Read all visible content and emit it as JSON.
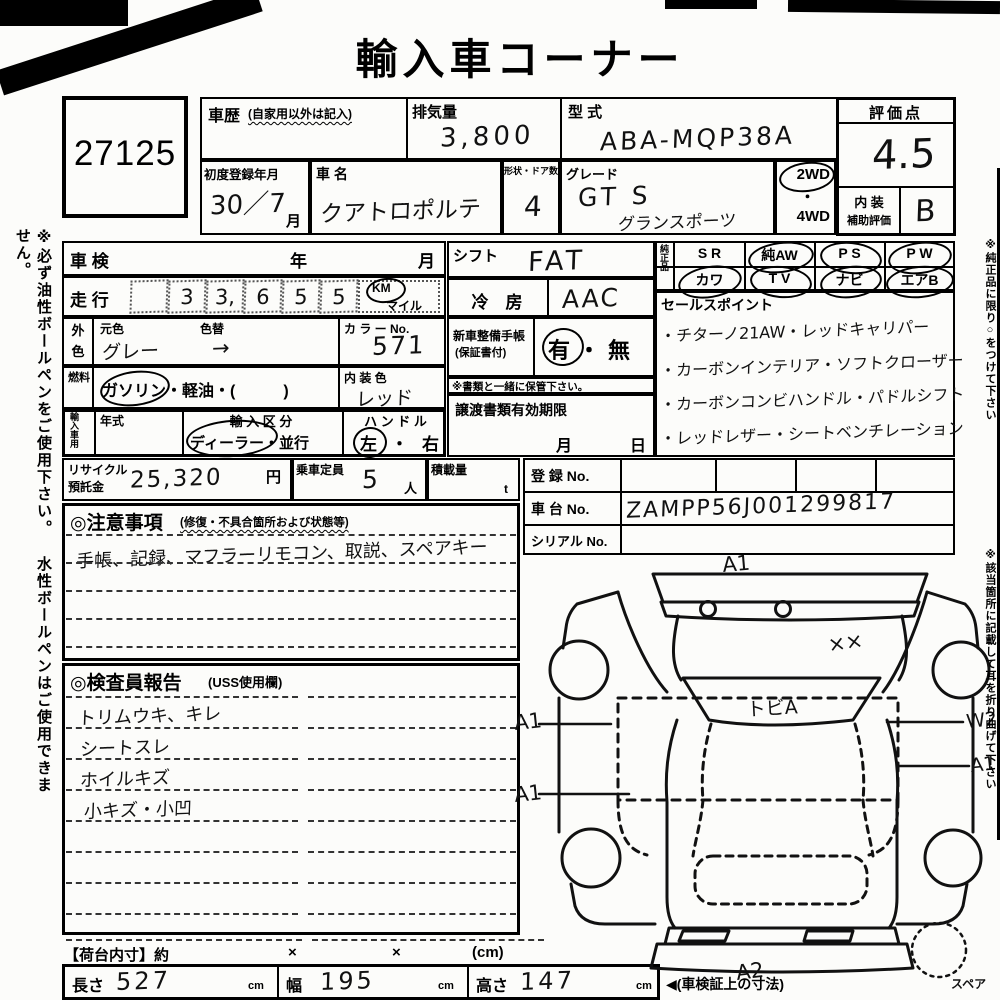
{
  "header": {
    "title": "輸入車コーナー"
  },
  "lot": {
    "number": "27125"
  },
  "margin_notes": {
    "left": "※必ず油性ボールペンをご使用下さい。 水性ボールペンはご使用できません。",
    "right1": "※純正品に限り○をつけて下さい",
    "right2": "※該当箇所に記載して耳を折り曲げて下さい"
  },
  "top": {
    "history_label": "車歴",
    "history_sub": "(自家用以外は記入)",
    "displacement_label": "排気量",
    "displacement_value": "3,800",
    "model_label": "型 式",
    "model_value": "ABA-MQP38A",
    "score_label": "評価点",
    "score_value": "4.5",
    "interior_label1": "内 装",
    "interior_label2": "補助評価",
    "interior_value": "B",
    "first_reg_label": "初度登録年月",
    "first_reg_value": "30／7",
    "first_reg_month_suffix": "月",
    "name_label": "車 名",
    "name_value": "クアトロポルテ",
    "shape_label": "形状・ドア数",
    "shape_value": "4",
    "grade_label": "グレード",
    "grade_value": "GT S",
    "grade_value2": "グランスポーツ",
    "drive_2wd": "2WD",
    "drive_dot": "・",
    "drive_4wd": "4WD",
    "drive_circled": "2WD"
  },
  "inspection_row": {
    "label": "車 検",
    "year": "年",
    "month": "月",
    "value": ""
  },
  "mileage": {
    "label": "走 行",
    "digits": [
      "",
      "3",
      "3,",
      "6",
      "5",
      "5"
    ],
    "value": "33,655",
    "unit_top": "KM",
    "unit_bottom": "マイル",
    "unit_circled": "KM"
  },
  "exterior": {
    "side_label": "外色",
    "orig_label": "元色",
    "orig_value": "グレー",
    "change_label": "色替",
    "change_value": "→",
    "colorno_label": "カ ラ ー No.",
    "colorno_value": "571"
  },
  "fuel": {
    "side_label": "燃料",
    "options": "ガソリン・軽油・(　　　)",
    "circled": "ガソリン",
    "interior_label": "内 装 色",
    "interior_value": "レッド"
  },
  "import_use": {
    "side_label": "輸入車用",
    "year_label": "年式",
    "year_value": "",
    "division_label": "輸 入 区 分",
    "division_options": "ディーラー・並行",
    "division_circled": "ディーラー",
    "handle_label": "ハ ン ド ル",
    "handle_options": "左・右",
    "handle_circled": "左"
  },
  "shift": {
    "label": "シフト",
    "value": "FAT"
  },
  "ac": {
    "label": "冷　房",
    "value": "AAC"
  },
  "service_book": {
    "label1": "新車整備手帳",
    "label2": "(保証書付)",
    "options": "有・無",
    "circled": "有",
    "note": "※書類と一緒に保管下さい。"
  },
  "transfer": {
    "label": "譲渡書類有効期限",
    "month": "月",
    "day": "日"
  },
  "genuine": {
    "side_label": "純正品",
    "cols": [
      {
        "top": "S R",
        "bottom": "カワ"
      },
      {
        "top": "純AW",
        "bottom": "T V"
      },
      {
        "top": "P S",
        "bottom": "ナビ"
      },
      {
        "top": "P W",
        "bottom": "エアB"
      }
    ],
    "circled": [
      "カワ",
      "純AW",
      "T V",
      "P S",
      "ナビ",
      "P W",
      "エアB"
    ]
  },
  "sales": {
    "label": "セールスポイント",
    "lines": [
      "・チターノ21AW・レッドキャリパー",
      "・カーボンインテリア・ソフトクローザー",
      "・カーボンコンビハンドル・パドルシフト",
      "・レッドレザー・シートベンチレーション"
    ]
  },
  "recycle": {
    "label1": "リサイクル",
    "label2": "預託金",
    "value": "25,320",
    "unit": "円"
  },
  "capacity": {
    "label": "乗車定員",
    "value": "5",
    "unit": "人"
  },
  "load": {
    "label": "積載量",
    "value": "",
    "unit": "t"
  },
  "registration": {
    "reg_label": "登 録 No.",
    "reg_value": "",
    "chassis_label": "車 台 No.",
    "chassis_value": "ZAMPP56J001299817",
    "serial_label": "シリアル No.",
    "serial_value": ""
  },
  "cautions": {
    "header": "◎注意事項",
    "header_sub": "(修復・不具合箇所および状態等)",
    "line": "手帳、記録、マフラーリモコン、取説、スペアキー"
  },
  "inspector": {
    "header": "◎検査員報告",
    "header_sub": "(USS使用欄)",
    "lines": [
      "トリムウキ、キレ",
      "シートスレ",
      "ホイルキズ",
      "小キズ・小凹"
    ]
  },
  "cargo": {
    "label": "【荷台内寸】約",
    "x1": "×",
    "x2": "×",
    "unit": "(cm)"
  },
  "dims": {
    "length_label": "長さ",
    "length_value": "527",
    "width_label": "幅",
    "width_value": "195",
    "height_label": "高さ",
    "height_value": "147",
    "unit": "cm",
    "note": "◀(車検証上の寸法)"
  },
  "diagram": {
    "top": "A1",
    "upper_right": "××",
    "windshield": "トビA",
    "left1": "A1",
    "left2": "A1",
    "right1": "W2",
    "right2": "A1",
    "bottom": "A2",
    "spare_label": "スペア"
  }
}
